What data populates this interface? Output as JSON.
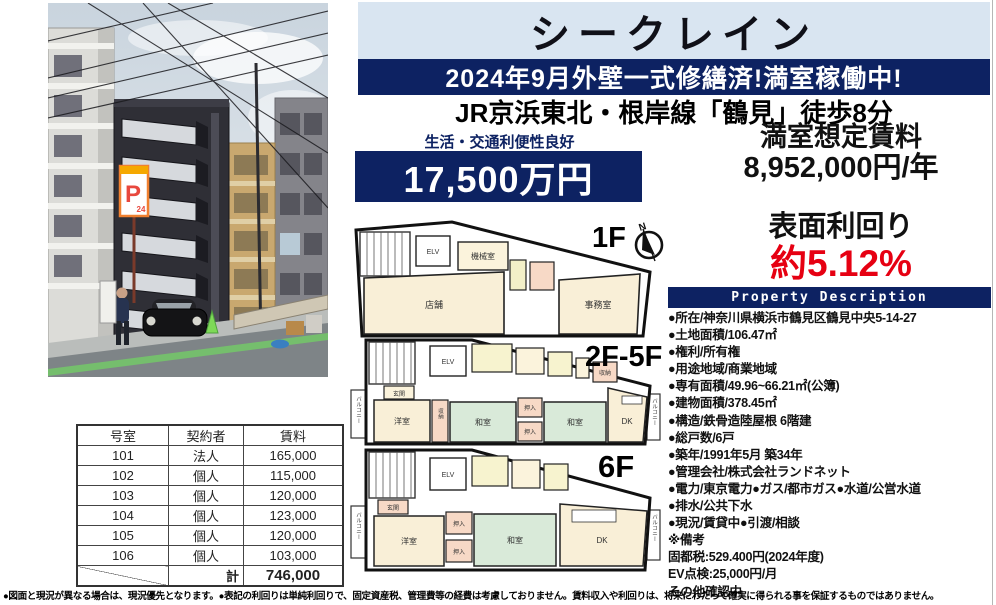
{
  "header": {
    "title": "シークレイン",
    "banner": "2024年9月外壁一式修繕済!満室稼働中!",
    "station": "JR京浜東北・根岸線「鶴見」徒歩8分"
  },
  "price": {
    "benefit": "生活・交通利便性良好",
    "amount": "17,500万円"
  },
  "rent": {
    "label": "満室想定賃料",
    "value": "8,952,000円/年"
  },
  "yield": {
    "label": "表面利回り",
    "value": "約5.12%"
  },
  "property": {
    "header": "Property Description",
    "items": [
      "●所在/神奈川県横浜市鶴見区鶴見中央5-14-27",
      "●土地面積/106.47㎡",
      "●権利/所有権",
      "●用途地域/商業地域",
      "●専有面積/49.96~66.21㎡(公簿)",
      "●建物面積/378.45㎡",
      "●構造/鉄骨造陸屋根 6階建",
      "●総戸数/6戸",
      "●築年/1991年5月 築34年",
      "●管理会社/株式会社ランドネット",
      "●電力/東京電力●ガス/都市ガス●水道/公営水道",
      "●排水/公共下水",
      "●現況/賃貸中●引渡/相談",
      "※備考",
      "固都税:529.400円(2024年度)",
      "EV点検:25,000円/月",
      "その他確認中"
    ]
  },
  "floorplans": {
    "compass": "N",
    "f1": {
      "label": "1F",
      "rooms": [
        "ELV",
        "機械室",
        "店舗",
        "事務室"
      ]
    },
    "f2_5": {
      "label": "2F-5F",
      "rooms": [
        "ELV",
        "収納",
        "玄関",
        "洋室",
        "収納",
        "和室",
        "押入",
        "押入",
        "和室",
        "DK",
        "バルコニー",
        "バルコニー"
      ]
    },
    "f6": {
      "label": "6F",
      "rooms": [
        "ELV",
        "玄関",
        "洋室",
        "押入",
        "押入",
        "和室",
        "DK",
        "バルコニー",
        "バルコニー"
      ]
    }
  },
  "photo": {
    "parking_sign_p": "P",
    "parking_sign_24": "24"
  },
  "tenant_table": {
    "headers": [
      "号室",
      "契約者",
      "賃料"
    ],
    "rows": [
      [
        "101",
        "法人",
        "165,000"
      ],
      [
        "102",
        "個人",
        "115,000"
      ],
      [
        "103",
        "個人",
        "120,000"
      ],
      [
        "104",
        "個人",
        "123,000"
      ],
      [
        "105",
        "個人",
        "120,000"
      ],
      [
        "106",
        "個人",
        "103,000"
      ]
    ],
    "total_label": "計",
    "total_value": "746,000"
  },
  "disclaimer": "●図面と現況が異なる場合は、現況優先となります。●表記の利回りは単純利回りで、固定資産税、管理費等の経費は考慮しておりません。賃料収入や利回りは、将来にわたって確実に得られる事を保証するものではありません。",
  "colors": {
    "navy": "#0d2262",
    "light_blue": "#d9e5f1",
    "red": "#e60012",
    "room_cream": "#f9efd7",
    "room_green": "#d9ead9",
    "room_pink": "#f7d9c6",
    "room_yellow": "#f7f3cf"
  }
}
